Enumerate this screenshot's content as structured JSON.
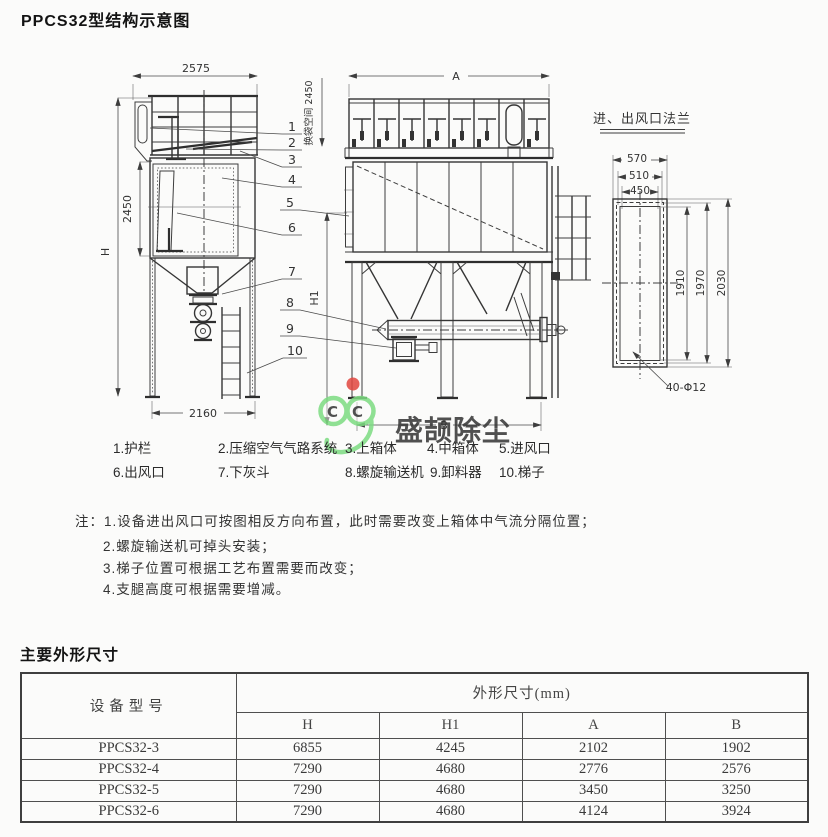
{
  "page": {
    "title": "PPCS32型结构示意图"
  },
  "drawing": {
    "left": {
      "w_top": "2575",
      "h_body": "2450",
      "h_total": "H",
      "w_bottom": "2160"
    },
    "front": {
      "w_top": "A",
      "bag_space": "换袋空间 2450",
      "h1": "H1",
      "w_bottom": "B"
    },
    "flange": {
      "title": "进、出风口法兰",
      "w_outer": "570",
      "w_bolt": "510",
      "w_inner": "450",
      "h_inner": "1910",
      "h_bolt": "1970",
      "h_outer": "2030",
      "bolt_note": "40-Φ12"
    },
    "callouts": [
      "1",
      "2",
      "3",
      "4",
      "5",
      "6",
      "7",
      "8",
      "9",
      "10"
    ]
  },
  "watermark": {
    "letter": "C",
    "text": "盛颉除尘",
    "green": "#7ddc82",
    "blue": "#a6c9ef",
    "yellow": "#e3d44f",
    "red": "#e2473f"
  },
  "legend": {
    "items": [
      "1.护栏",
      "2.压缩空气气路系统",
      "3.上箱体",
      "4.中箱体",
      "5.进风口",
      "6.出风口",
      "7.下灰斗",
      "8.螺旋输送机",
      "9.卸料器",
      "10.梯子"
    ]
  },
  "notes": {
    "prefix": "注：",
    "items": [
      "1.设备进出风口可按图相反方向布置，此时需要改变上箱体中气流分隔位置；",
      "2.螺旋输送机可掉头安装；",
      "3.梯子位置可根据工艺布置需要而改变；",
      "4.支腿高度可根据需要增减。"
    ]
  },
  "specs": {
    "title": "主要外形尺寸",
    "table": {
      "model_header": "设备型号",
      "group_header": "外形尺寸(mm)",
      "sub_headers": [
        "H",
        "H1",
        "A",
        "B"
      ],
      "rows": [
        {
          "model": "PPCS32-3",
          "values": [
            "6855",
            "4245",
            "2102",
            "1902"
          ]
        },
        {
          "model": "PPCS32-4",
          "values": [
            "7290",
            "4680",
            "2776",
            "2576"
          ]
        },
        {
          "model": "PPCS32-5",
          "values": [
            "7290",
            "4680",
            "3450",
            "3250"
          ]
        },
        {
          "model": "PPCS32-6",
          "values": [
            "7290",
            "4680",
            "4124",
            "3924"
          ]
        }
      ]
    }
  }
}
